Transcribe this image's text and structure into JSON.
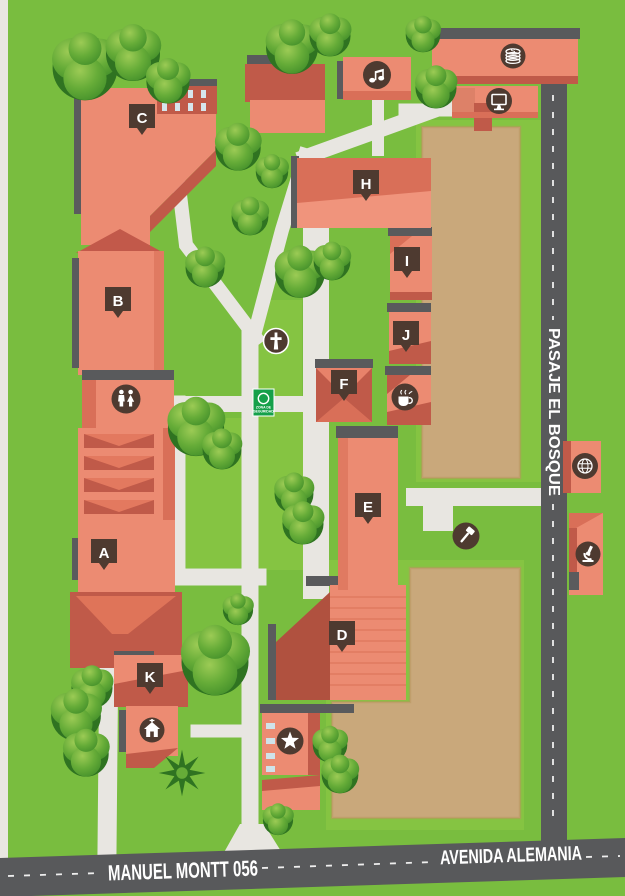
{
  "map": {
    "streets": {
      "bottom_left": "MANUEL MONTT 056",
      "bottom_right": "AVENIDA ALEMANIA",
      "right_vertical": "PASAJE EL BOSQUE"
    },
    "markers": [
      {
        "label": "A"
      },
      {
        "label": "B"
      },
      {
        "label": "C"
      },
      {
        "label": "D"
      },
      {
        "label": "E"
      },
      {
        "label": "F"
      },
      {
        "label": "H"
      },
      {
        "label": "I"
      },
      {
        "label": "J"
      },
      {
        "label": "K"
      }
    ],
    "safety_sign": {
      "line1": "ZONA DE",
      "line2": "SEGURIDAD"
    },
    "icons_text": {
      "coins_letter": "S"
    },
    "icons": [
      {
        "name": "music-note-icon"
      },
      {
        "name": "coins-icon"
      },
      {
        "name": "computer-monitor-icon"
      },
      {
        "name": "restrooms-icon"
      },
      {
        "name": "cross-icon"
      },
      {
        "name": "coffee-cup-icon"
      },
      {
        "name": "gavel-icon"
      },
      {
        "name": "star-icon"
      },
      {
        "name": "house-icon"
      },
      {
        "name": "globe-icon"
      },
      {
        "name": "microscope-icon"
      }
    ],
    "colors": {
      "grass": "#79BD3F",
      "grass_light": "#87C642",
      "path": "#E8E6E1",
      "road": "#58595B",
      "building": "#EC8B72",
      "building_dark": "#C05A49",
      "building_shade": "#D96F58",
      "roof_edge": "#595A5C",
      "field": "#C9A87B",
      "marker_bg": "#4E3A30",
      "sign_green": "#15A04A",
      "tree_green": "#45912B"
    }
  }
}
